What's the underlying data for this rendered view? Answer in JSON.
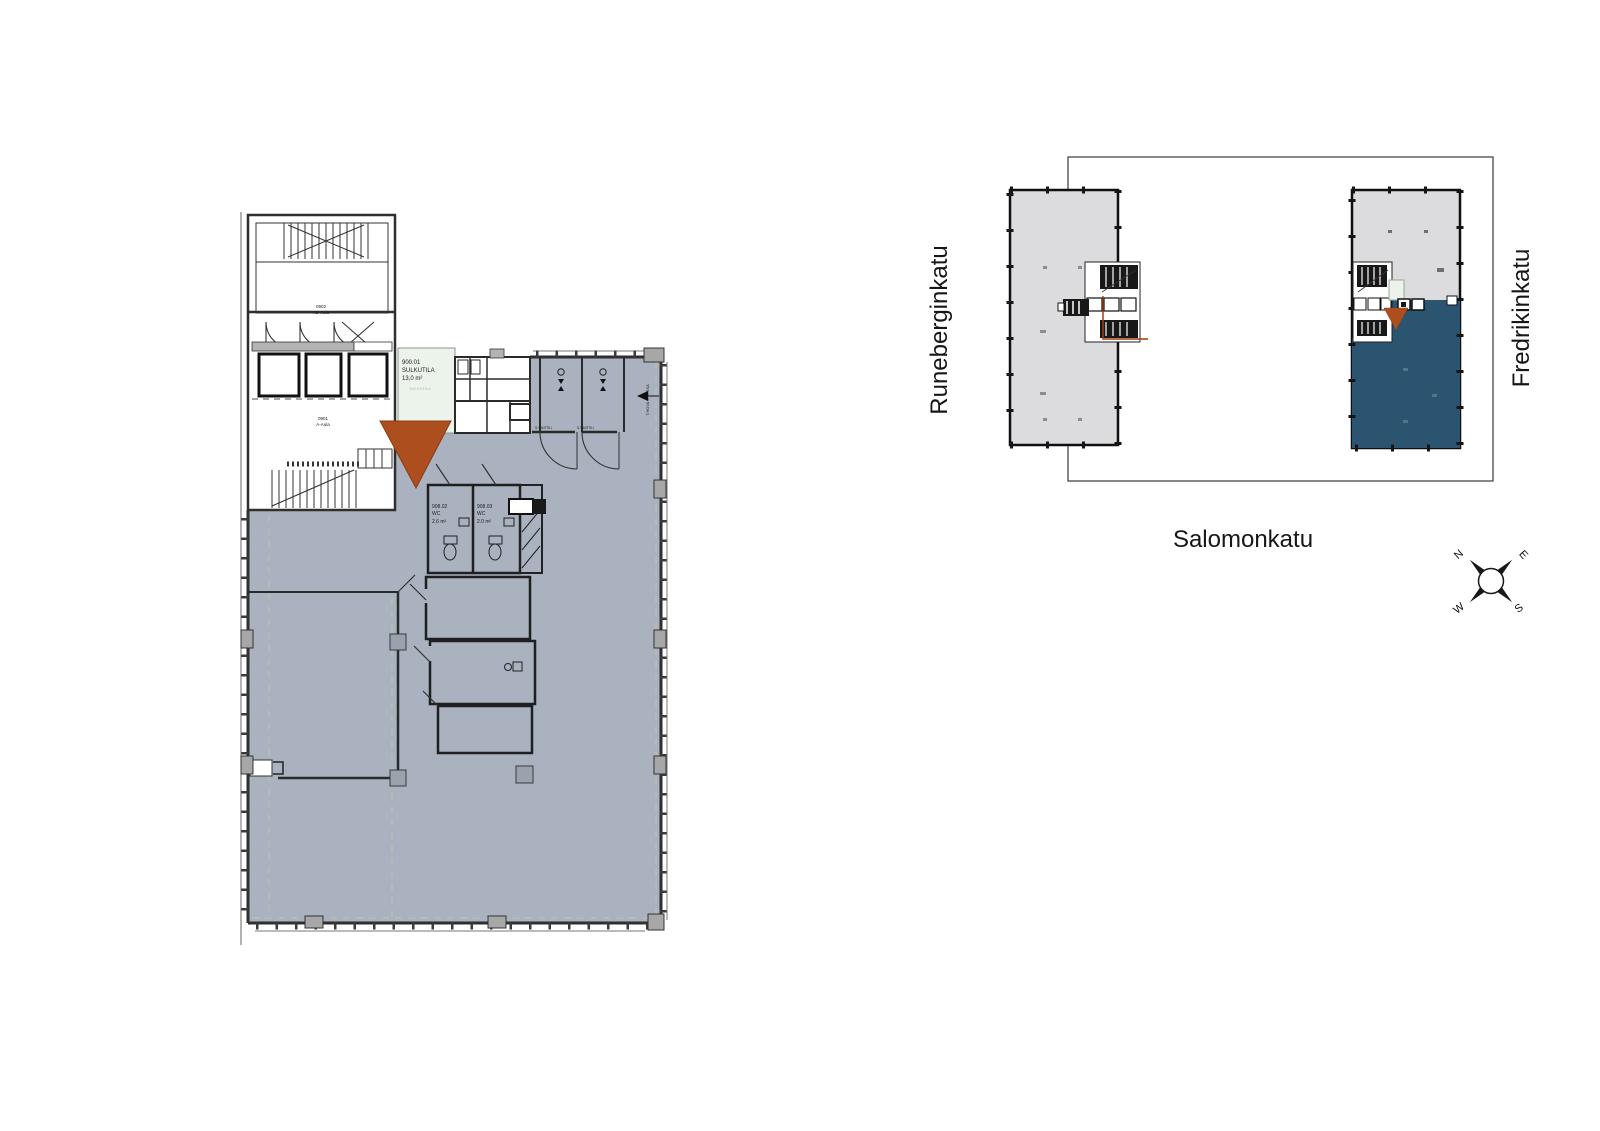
{
  "colors": {
    "hall": "#a9b2be",
    "navy": "#2b5470",
    "orange": "#ac4e1e",
    "keyplan_gray": "#dcdcde",
    "green": "#ecf3ea",
    "guide": "#b9c6b2"
  },
  "floor_plan": {
    "rooms": [
      {
        "id": "0902",
        "name": "A2-Aula"
      },
      {
        "id": "0901",
        "name": "A-Aula"
      },
      {
        "id": "900.01",
        "name": "SULKUTILA",
        "area": "13,0 m²",
        "note": "SULKUTILA"
      },
      {
        "id": "908.02",
        "name": "WC",
        "area": "2.6 m²"
      },
      {
        "id": "908.03",
        "name": "WC",
        "area": "2.0 m²"
      }
    ],
    "door_labels": [
      "S-VANTTILI",
      "S-VANTTILI"
    ],
    "wall_note": "T.HOVA OVESSA"
  },
  "key_plan": {
    "streets": {
      "left": "Runeberginkatu",
      "bottom": "Salomonkatu",
      "right": "Fredrikinkatu"
    },
    "compass": {
      "n": "N",
      "e": "E",
      "s": "S",
      "w": "W"
    }
  }
}
